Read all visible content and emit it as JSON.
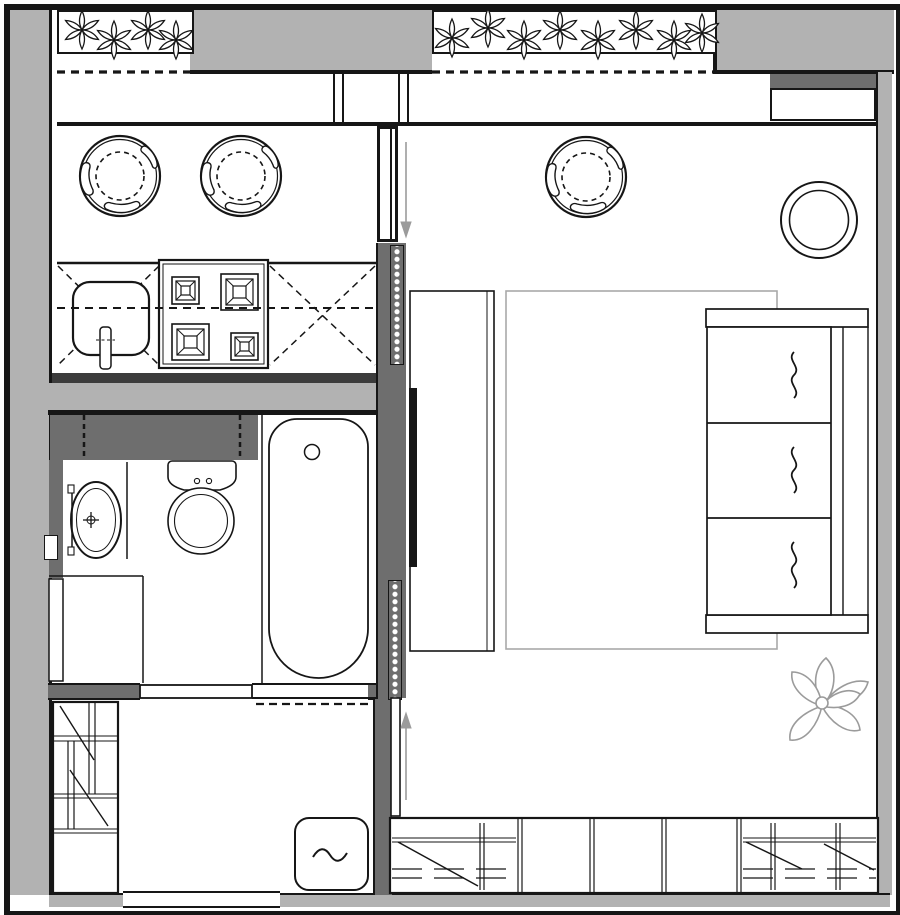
{
  "canvas": {
    "width": 900,
    "height": 915
  },
  "palette": {
    "line": "#161616",
    "wall-light": "#b2b2b2",
    "wall-dark": "#6e6e6e",
    "band-dark": "#3c3c3c",
    "soft": "#a9a9a9",
    "accent-gray": "#9b9b9b",
    "paper": "#ffffff"
  },
  "furniture": {
    "round_chairs": [
      [
        120,
        176
      ],
      [
        241,
        176
      ],
      [
        586,
        177
      ]
    ],
    "stove_burner_count": 4,
    "sofa_cushion_count": 3,
    "closet_section_dividers": 4,
    "side_table_center": [
      819,
      220
    ]
  },
  "decor": {
    "planter1_flowers": [
      [
        82,
        30
      ],
      [
        114,
        40
      ],
      [
        148,
        30
      ],
      [
        176,
        40
      ]
    ],
    "planter2_flowers": [
      [
        452,
        38
      ],
      [
        488,
        28
      ],
      [
        524,
        40
      ],
      [
        560,
        30
      ],
      [
        598,
        40
      ],
      [
        636,
        30
      ],
      [
        674,
        40
      ],
      [
        702,
        33
      ]
    ]
  },
  "inventory": [
    "balcony-planter-left",
    "balcony-planter-right",
    "kitchen-bar-chair",
    "kitchen-sink",
    "cooktop-4-burner",
    "countertop",
    "bathroom-sink",
    "toilet",
    "bathtub",
    "wardrobe",
    "washing-machine",
    "entry-door-opening",
    "sliding-door-top",
    "sliding-door-bottom",
    "accordion-door",
    "tv-panel",
    "sideboard",
    "rug",
    "lounge-chair",
    "side-table",
    "sofa-3-seat",
    "floor-plant",
    "wall-closet-row"
  ],
  "symbols": {
    "squiggle": "cushion-marker",
    "dashed-cross": "countertop-area-marker",
    "dashed-circle": "chair-seat-marker",
    "arrow": "sliding-door-direction"
  }
}
